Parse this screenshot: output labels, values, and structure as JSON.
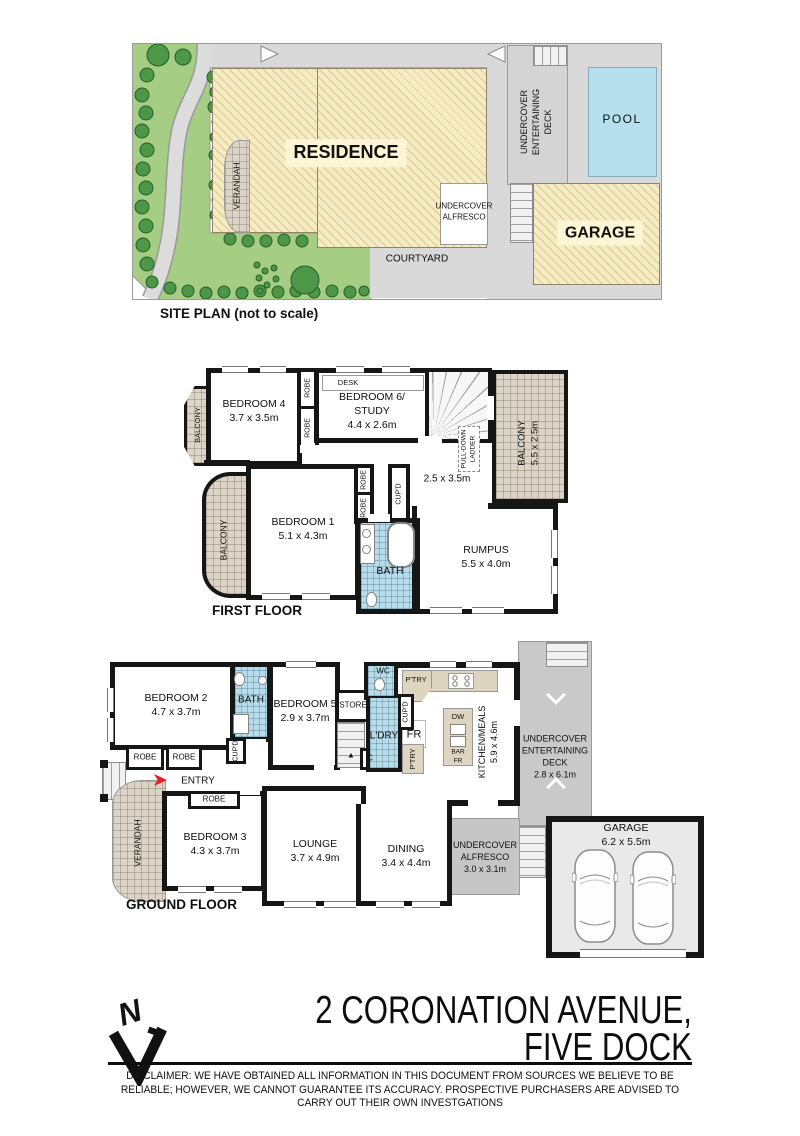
{
  "site": {
    "title": "SITE PLAN (not to scale)",
    "residence": "RESIDENCE",
    "verandah": "VERANDAH",
    "deck": "UNDERCOVER\nENTERTAINING\nDECK",
    "pool": "POOL",
    "alfresco": "UNDERCOVER\nALFRESCO",
    "garage": "GARAGE",
    "courtyard": "COURTYARD"
  },
  "first_floor": {
    "title": "FIRST FLOOR",
    "balcony": "BALCONY",
    "bedroom4": "BEDROOM 4\n3.7 x 3.5m",
    "robe": "ROBE",
    "desk": "DESK",
    "bedroom6": "BEDROOM 6/\nSTUDY\n4.4 x 2.6m",
    "ladder": "PULL-DOWN\nLADDER",
    "balcony_right": "BALCONY\n5.5 x 2.5m",
    "landing_dims": "2.5 x 3.5m",
    "bedroom1": "BEDROOM 1\n5.1 x 4.3m",
    "cupd": "CUP'D",
    "bath": "BATH",
    "rumpus": "RUMPUS\n5.5 x 4.0m"
  },
  "ground_floor": {
    "title": "GROUND FLOOR",
    "bedroom2": "BEDROOM 2\n4.7 x 3.7m",
    "bath": "BATH",
    "bedroom5": "BEDROOM 5\n2.9 x 3.7m",
    "store": "STORE",
    "wc": "WC",
    "cupd": "CUP'D",
    "ldry": "L'DRY",
    "fr": "FR",
    "ptry": "P'TRY",
    "dw": "DW",
    "bar_fr": "BAR\nFR",
    "kitchen": "KITCHEN/MEALS\n5.9 x 4.6m",
    "robe": "ROBE",
    "entry": "ENTRY",
    "c": "C",
    "verandah": "VERANDAH",
    "bedroom3": "BEDROOM 3\n4.3 x 3.7m",
    "lounge": "LOUNGE\n3.7 x 4.9m",
    "dining": "DINING\n3.4 x 4.4m",
    "alfresco": "UNDERCOVER\nALFRESCO\n3.0 x 3.1m",
    "deck": "UNDERCOVER\nENTERTAINING\nDECK\n2.8 x 6.1m",
    "garage": "GARAGE\n6.2 x 5.5m"
  },
  "footer": {
    "north": "N",
    "address": "2 CORONATION AVENUE,\nFIVE DOCK",
    "disclaimer": "DISCLAIMER: WE HAVE OBTAINED ALL INFORMATION IN THIS DOCUMENT FROM SOURCES WE BELIEVE TO BE RELIABLE; HOWEVER, WE CANNOT GUARANTEE ITS ACCURACY. PROSPECTIVE PURCHASERS ARE ADVISED TO CARRY OUT THEIR OWN INVESTGATIONS"
  },
  "colors": {
    "garden": "#a6cd84",
    "hatch_fill": "#f6ecc4",
    "pool": "#b6e0ee",
    "site_gray": "#d9d9d9",
    "bath_tile": "#b9dcea",
    "accent_red": "#e31e24"
  }
}
